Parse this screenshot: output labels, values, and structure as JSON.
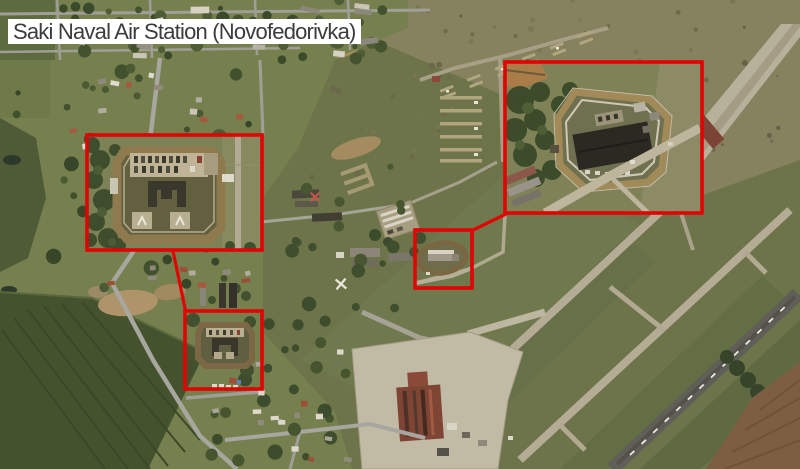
{
  "title": {
    "label": "Saki Naval Air Station (Novofedorivka)"
  },
  "map": {
    "type": "satellite-imagery",
    "annotation_color": "#e10404",
    "annotations": [
      {
        "id": "annotation-box-fort-inset",
        "x": 87,
        "y": 135,
        "w": 175,
        "h": 115
      },
      {
        "id": "annotation-box-fort-site",
        "x": 185,
        "y": 311,
        "w": 77,
        "h": 78
      },
      {
        "id": "annotation-box-hq-site",
        "x": 415,
        "y": 230,
        "w": 57,
        "h": 58
      },
      {
        "id": "annotation-box-hq-inset",
        "x": 505,
        "y": 62,
        "w": 197,
        "h": 151
      }
    ],
    "leader_lines": [
      {
        "id": "annotation-leader-fort",
        "x1": 173,
        "y1": 251,
        "x2": 186,
        "y2": 313
      },
      {
        "id": "annotation-leader-hq",
        "x1": 471,
        "y1": 231,
        "x2": 506,
        "y2": 214
      }
    ]
  }
}
